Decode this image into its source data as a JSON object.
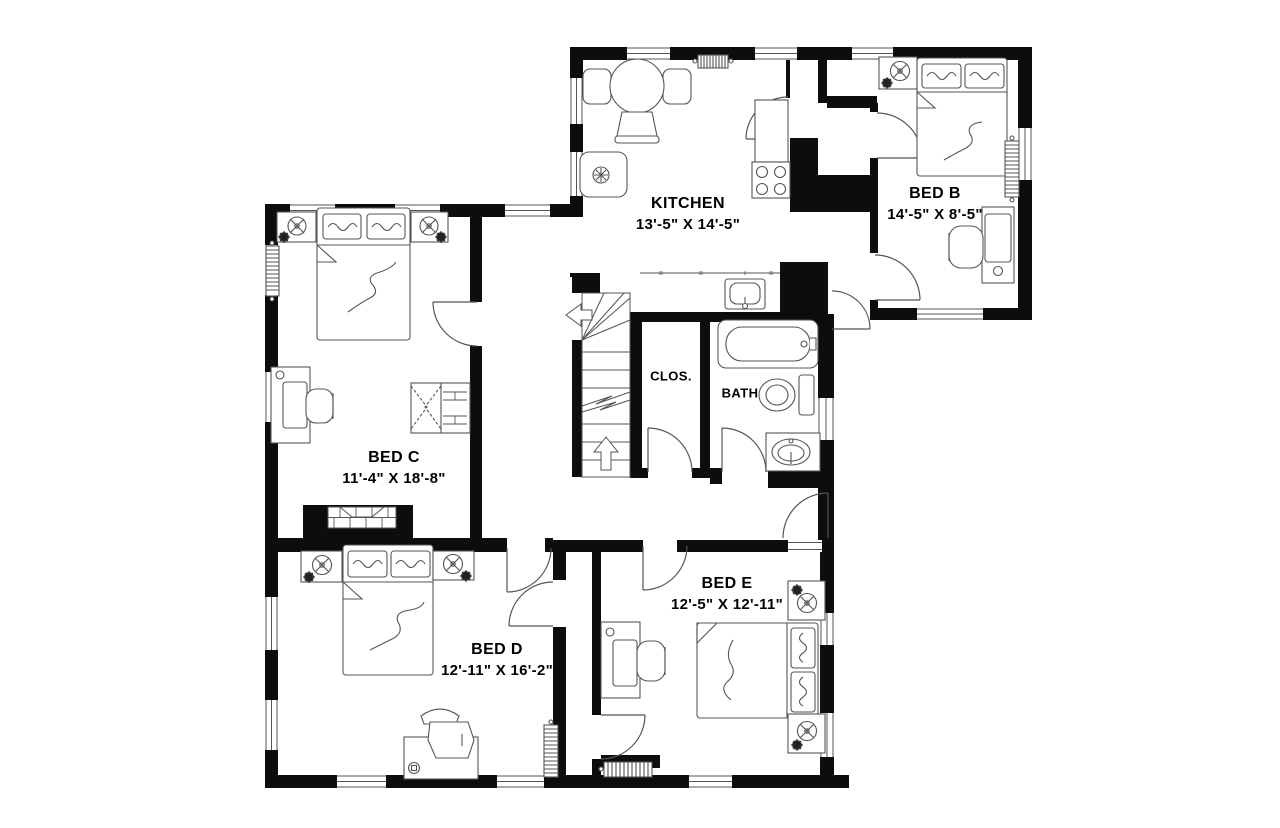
{
  "floor_plan": {
    "background_color": "#ffffff",
    "wall_color": "#0d0d0d",
    "line_color": "#555555",
    "text_color": "#000000",
    "rooms": [
      {
        "key": "kitchen",
        "name": "KITCHEN",
        "dimensions": "13'-5\" X 14'-5\""
      },
      {
        "key": "bed-b",
        "name": "BED B",
        "dimensions": "14'-5\" X 8'-5\""
      },
      {
        "key": "bed-c",
        "name": "BED C",
        "dimensions": "11'-4\" X 18'-8\""
      },
      {
        "key": "bed-d",
        "name": "BED D",
        "dimensions": "12'-11\" X 16'-2\""
      },
      {
        "key": "bed-e",
        "name": "BED E",
        "dimensions": "12'-5\" X 12'-11\""
      },
      {
        "key": "closet",
        "name": "CLOS.",
        "dimensions": ""
      },
      {
        "key": "bath",
        "name": "BATH",
        "dimensions": ""
      }
    ],
    "fixture_icons": [
      "stairs-icon",
      "bathtub-icon",
      "toilet-icon",
      "vanity-sink-icon",
      "kitchen-sink-icon",
      "stove-icon",
      "refrigerator-icon",
      "dining-table-icon",
      "fireplace-icon",
      "radiator-icon",
      "bed-icon",
      "nightstand-lamp-icon",
      "desk-chair-icon",
      "closet-unit-icon"
    ]
  }
}
